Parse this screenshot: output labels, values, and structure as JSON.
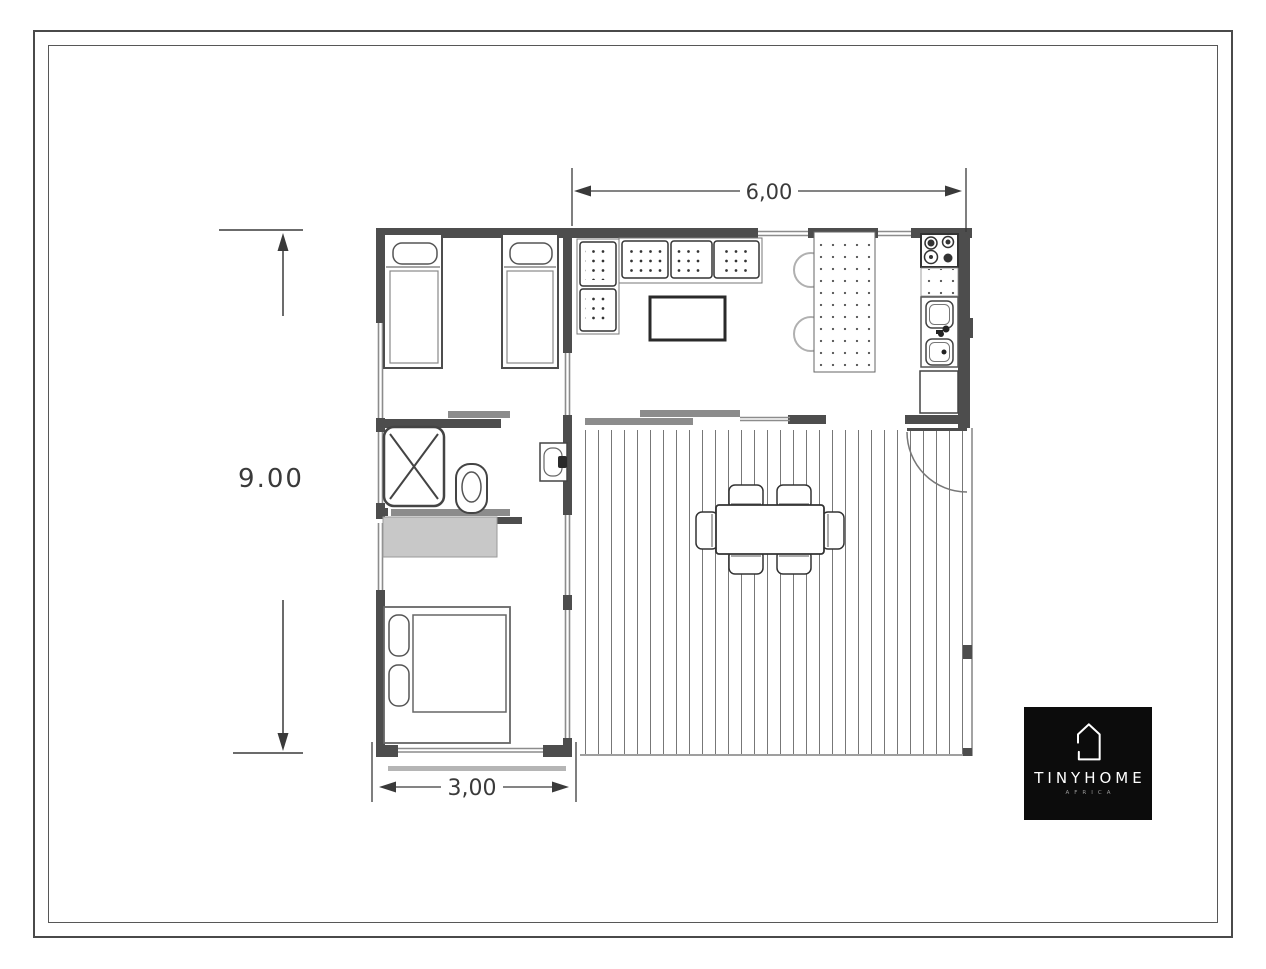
{
  "plan": {
    "dimensions": {
      "top": "6,00",
      "left": "9.00",
      "bottom": "3,00"
    }
  },
  "logo": {
    "title": "TINYHOME",
    "subtitle": "AFRICA"
  },
  "colors": {
    "wall": "#4d4d4d",
    "drawing_line": "#333333",
    "glazing": "#8c8c8c",
    "sliding_panel": "#8c8c8c",
    "wardrobe_fill": "#c8c8c8",
    "deck_plank_line": "#777777",
    "logo_background": "#0c0c0c",
    "logo_text": "#ffffff",
    "page_background": "#ffffff"
  }
}
